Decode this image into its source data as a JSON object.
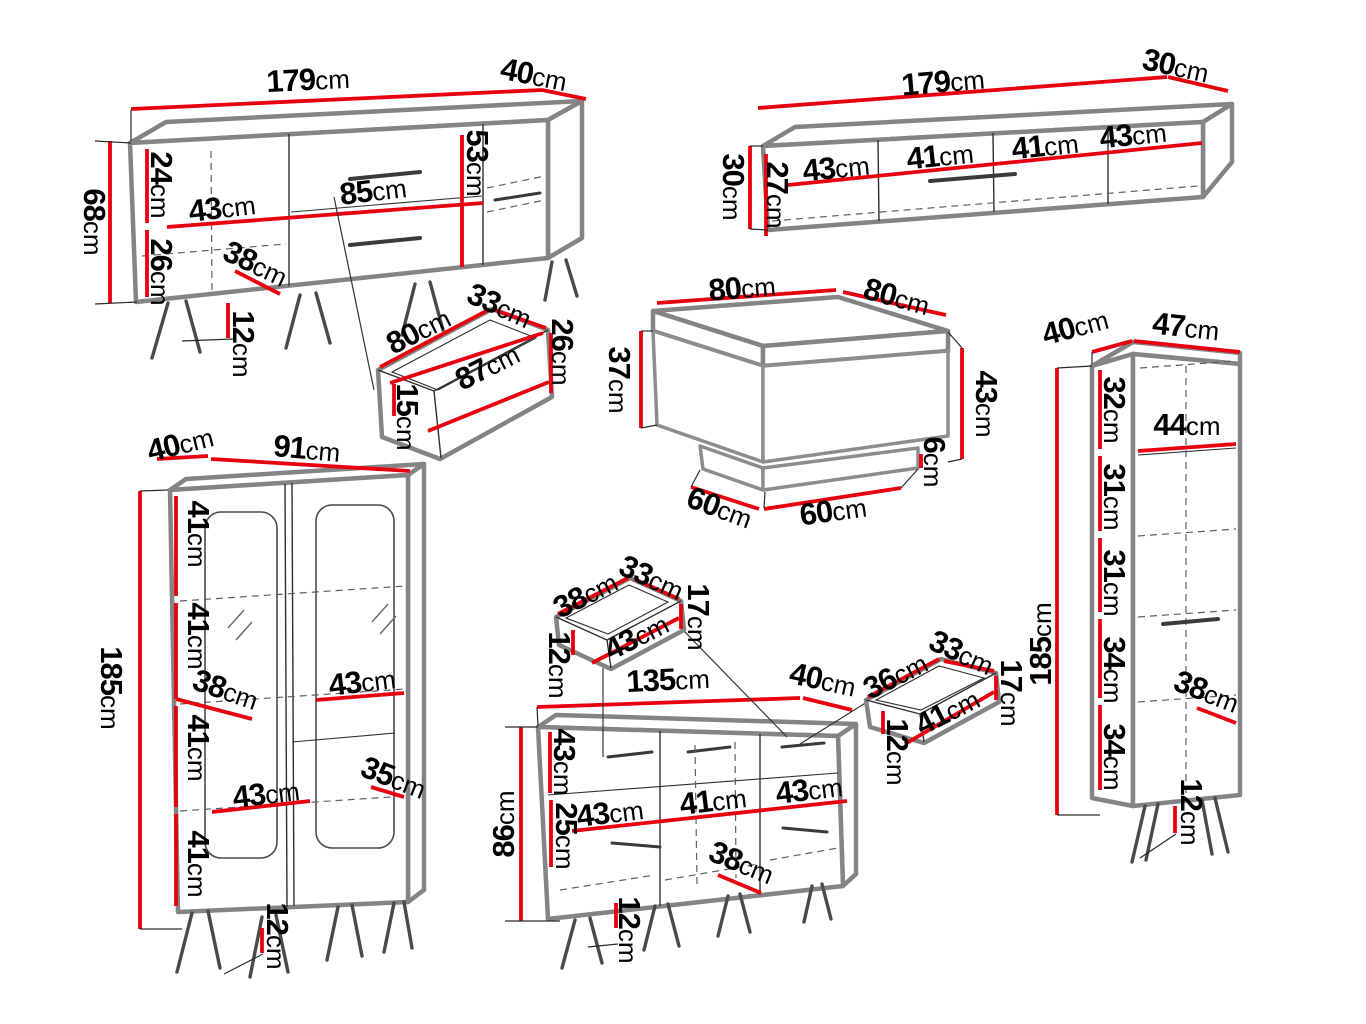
{
  "units": "cm",
  "colors": {
    "dimension_line": "#e8000f",
    "furniture_outline": "#848484",
    "detail_line": "#2f2f2f",
    "text": "#000000",
    "background": "#ffffff"
  },
  "pieces": {
    "sideboard": {
      "width": "179",
      "depth": "40",
      "height": "68",
      "upper_inner_height": "24",
      "lower_inner_height": "26",
      "compartment_width": "43",
      "drawer_width": "85",
      "drawer_section_height": "53",
      "shelf_depth": "38",
      "leg_height": "12"
    },
    "tv_stand": {
      "width": "179",
      "depth": "30",
      "height": "30",
      "inner_height": "27",
      "compartment_1": "43",
      "compartment_2": "41",
      "compartment_3": "41",
      "compartment_4": "43"
    },
    "big_drawer": {
      "inner_width": "80",
      "inner_depth": "33",
      "front_width": "87",
      "front_height": "26",
      "inner_height": "15"
    },
    "coffee_table": {
      "top_width": "80",
      "top_depth": "80",
      "height_left": "37",
      "height_right": "43",
      "plinth_height": "6",
      "base_width": "60",
      "base_depth": "60"
    },
    "tall_cabinet": {
      "depth": "40",
      "width": "47",
      "height": "185",
      "section_1": "32",
      "shelf_width": "44",
      "section_2": "31",
      "section_3": "31",
      "section_4": "34",
      "section_5": "34",
      "shelf_depth": "38",
      "leg_height": "12"
    },
    "vitrine": {
      "depth": "40",
      "width": "91",
      "height": "185",
      "section_1": "41",
      "section_2": "41",
      "section_3": "41",
      "section_4": "41",
      "shelf_depth": "38",
      "upper_shelf_width": "43",
      "lower_shelf_width": "43",
      "side_shelf_width": "35",
      "leg_height": "12"
    },
    "chest": {
      "width": "135",
      "depth": "40",
      "height": "86",
      "drawer_row_height": "43",
      "door_height": "25",
      "compartment_1": "43",
      "compartment_2": "41",
      "compartment_3": "43",
      "shelf_depth": "38",
      "leg_height": "12"
    },
    "chest_drawer_left": {
      "inner_width": "38",
      "inner_depth": "33",
      "front_width": "43",
      "front_height": "17",
      "inner_height": "12"
    },
    "chest_drawer_right": {
      "inner_width": "36",
      "inner_depth": "33",
      "front_width": "41",
      "front_height": "17",
      "inner_height": "12"
    }
  }
}
